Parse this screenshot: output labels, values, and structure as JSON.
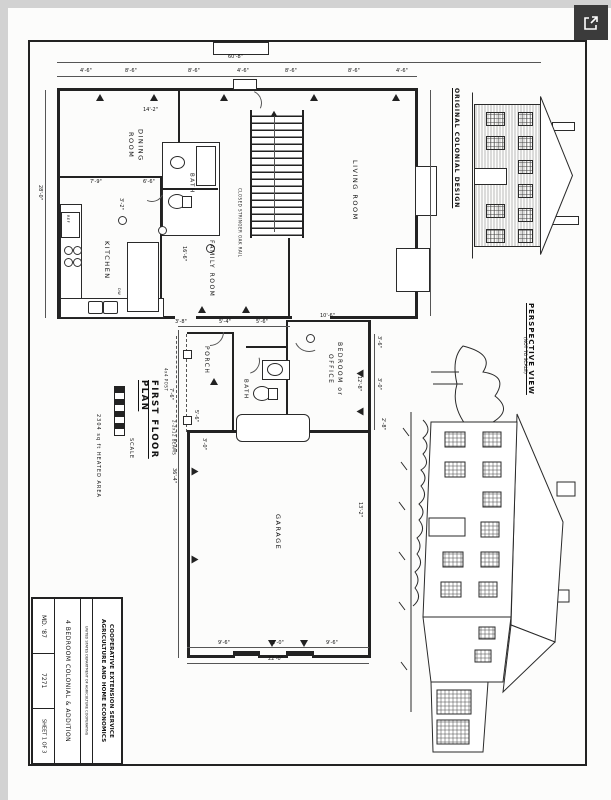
{
  "icons": {
    "open_button": "open-in-new-icon"
  },
  "titles": {
    "plan": "FIRST FLOOR PLAN",
    "scale": "SCALE",
    "heated_area": "2304 sq ft HEATED AREA",
    "original_design": "ORIGINAL COLONIAL DESIGN",
    "perspective": "PERSPECTIVE VIEW",
    "perspective_note": "(NOT TO SCALE)"
  },
  "rooms": {
    "living": "LIVING ROOM",
    "dining": "DINING ROOM",
    "kitchen": "KITCHEN",
    "family": "FAMILY ROOM",
    "bath_upper": "BATH",
    "bath_lower": "BATH",
    "porch": "PORCH",
    "bedroom": "BEDROOM or OFFICE",
    "garage": "GARAGE"
  },
  "annotations": {
    "stair_rail": "CLOSED STRINGER OAK RAIL",
    "post": "4x4 POST",
    "beams": "2-2x12 BEAMS",
    "ref": "REF",
    "dw": "DW"
  },
  "dims": {
    "overall_top": "60'-8\"",
    "seg1": "4'-6\"",
    "seg2": "8'-6\"",
    "seg3": "8'-6\"",
    "seg4": "4'-6\"",
    "seg5": "8'-6\"",
    "seg6": "8'-6\"",
    "seg7": "4'-6\"",
    "left_depth": "28'-0\"",
    "dining_w": "14'-2\"",
    "kitchen_a": "7'-9\"",
    "kitchen_b": "6'-6\"",
    "kitchen_c": "3'-2\"",
    "family_a": "3'-8\"",
    "family_b": "5'-4\"",
    "family_c": "5'-6\"",
    "family_d": "16'-6\"",
    "addition_side": "36'-4\"",
    "porch_a": "7'-6\"",
    "porch_b": "5'-6\"",
    "porch_c": "3'-0\"",
    "bed_w": "10'-6\"",
    "bed_d": "12'-8\"",
    "bed_a": "3'-6\"",
    "bed_b": "3'-0\"",
    "bed_c": "2'-8\"",
    "garage_side": "13'-2\"",
    "garage_a": "9'-6\"",
    "garage_b": "3'-0\"",
    "garage_c": "9'-6\"",
    "garage_w": "22'-0\""
  },
  "title_block": {
    "org_line1": "COOPERATIVE EXTENSION SERVICE",
    "org_line2": "AGRICULTURE AND HOME ECONOMICS",
    "usda": "UNITED STATES DEPARTMENT OF AGRICULTURE COOPERATING",
    "project": "4 BEDROOM COLONIAL & ADDITION",
    "plan_no": "MD. '87",
    "drawing_no": "7271",
    "sheet": "SHEET 1 OF 3"
  }
}
